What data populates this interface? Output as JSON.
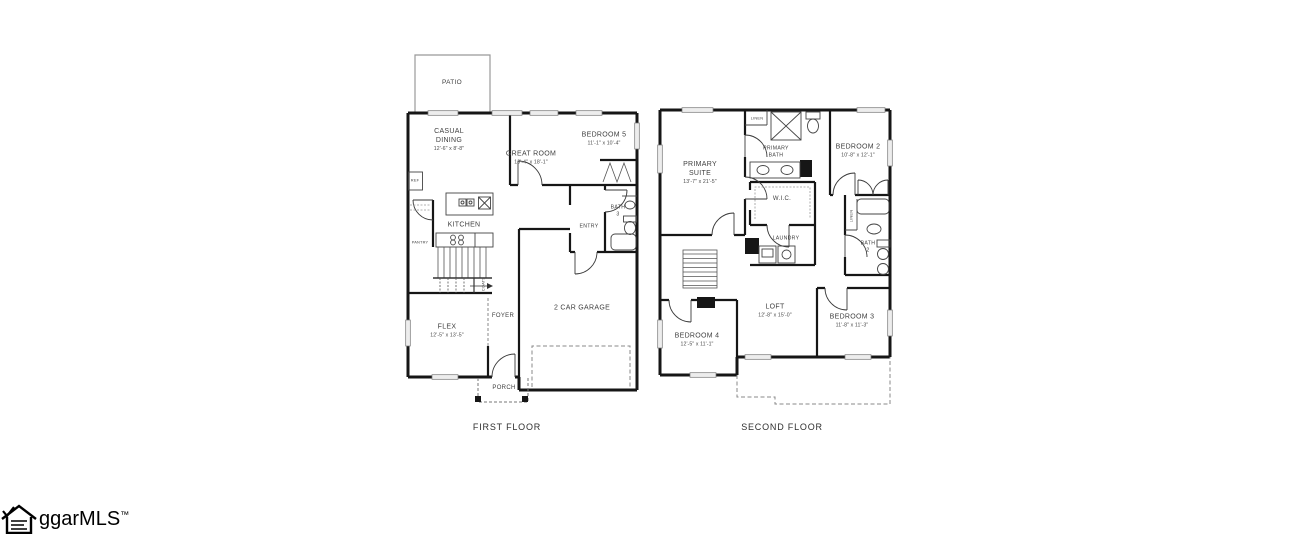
{
  "colors": {
    "walls": "#161616",
    "background": "#ffffff",
    "text": "#3f3f3f"
  },
  "watermark": {
    "text": "ggarMLS",
    "tm": "™"
  },
  "first_floor": {
    "caption": "FIRST FLOOR",
    "patio": {
      "name": "PATIO"
    },
    "casual_dining": {
      "name": "CASUAL DINING",
      "dims": "12'-6\" x 8'-8\""
    },
    "great_room": {
      "name": "GREAT ROOM",
      "dims": "13'-4\" x 18'-1\""
    },
    "bedroom5": {
      "name": "BEDROOM 5",
      "dims": "11'-1\" x 10'-4\""
    },
    "kitchen": {
      "name": "KITCHEN"
    },
    "ref": {
      "name": "REF"
    },
    "pantry": {
      "name": "PANTRY"
    },
    "coats": {
      "name": "COATS"
    },
    "bath3": {
      "name": "BATH 3"
    },
    "entry": {
      "name": "ENTRY"
    },
    "garage": {
      "name": "2 CAR GARAGE"
    },
    "flex": {
      "name": "FLEX",
      "dims": "12'-5\" x 13'-5\""
    },
    "foyer": {
      "name": "FOYER"
    },
    "porch": {
      "name": "PORCH"
    }
  },
  "second_floor": {
    "caption": "SECOND FLOOR",
    "primary_suite": {
      "name": "PRIMARY SUITE",
      "dims": "13'-7\" x 21'-5\""
    },
    "primary_bath": {
      "name": "PRIMARY BATH"
    },
    "linen_upper": {
      "name": "LINEN"
    },
    "bedroom2": {
      "name": "BEDROOM 2",
      "dims": "10'-8\" x 12'-1\""
    },
    "wic": {
      "name": "W.I.C."
    },
    "laundry": {
      "name": "LAUNDRY"
    },
    "linen_hall": {
      "name": "LINEN"
    },
    "bath2": {
      "name": "BATH 2"
    },
    "loft": {
      "name": "LOFT",
      "dims": "12'-8\" x 15'-0\""
    },
    "bedroom4": {
      "name": "BEDROOM 4",
      "dims": "12'-5\" x 11'-1\""
    },
    "bedroom3": {
      "name": "BEDROOM 3",
      "dims": "11'-8\" x 11'-3\""
    }
  }
}
